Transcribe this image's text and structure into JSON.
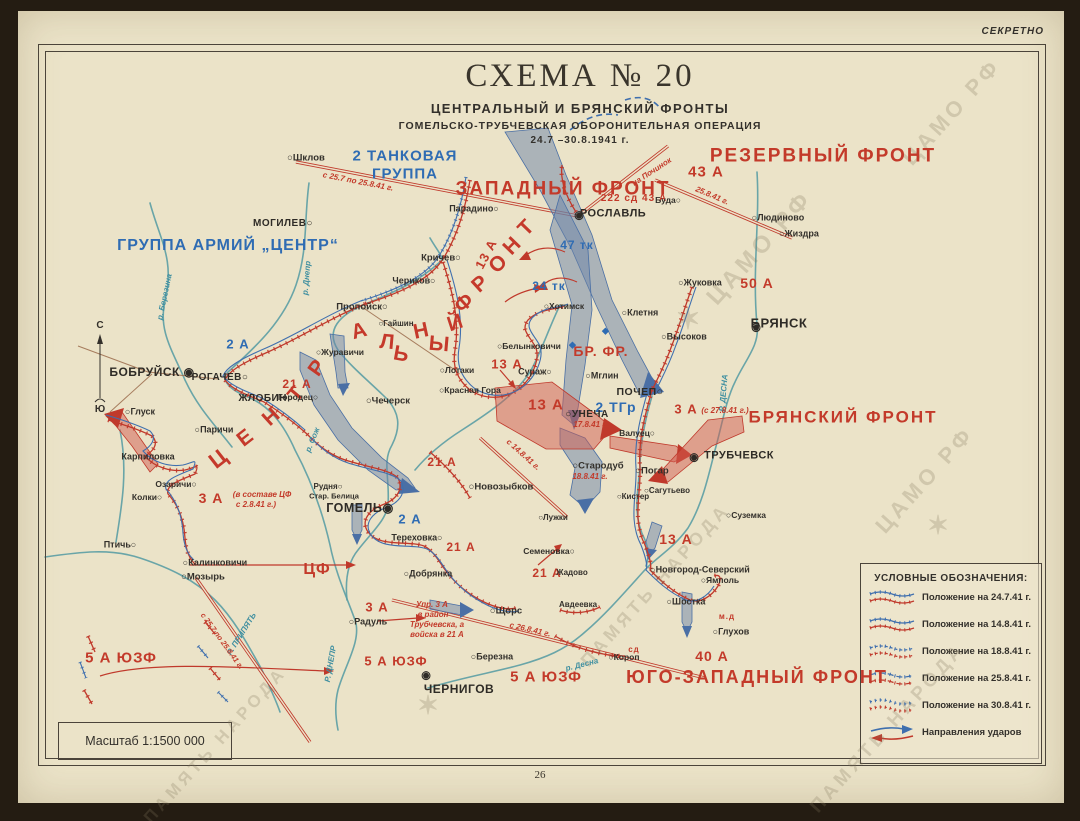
{
  "page": {
    "secret": "СЕКРЕТНО",
    "number": "26",
    "scale": "Масштаб 1:1500 000"
  },
  "title": {
    "main": "СХЕМА  № 20",
    "sub1": "ЦЕНТРАЛЬНЫЙ И БРЯНСКИЙ ФРОНТЫ",
    "sub2": "ГОМЕЛЬСКО-ТРУБЧЕВСКАЯ ОБОРОНИТЕЛЬНАЯ ОПЕРАЦИЯ",
    "dates": "24.7 –30.8.1941 г."
  },
  "colors": {
    "red": "#c0392b",
    "blue": "#2f6cb3",
    "river": "#5b9da4",
    "paper": "#ebe3c8",
    "ink": "#33302b"
  },
  "legend": {
    "title": "УСЛОВНЫЕ ОБОЗНАЧЕНИЯ:",
    "items": [
      {
        "label": "Положение на 24.7.41 г.",
        "sym": "pos1"
      },
      {
        "label": "Положение на 14.8.41 г.",
        "sym": "pos2"
      },
      {
        "label": "Положение на 18.8.41 г.",
        "sym": "pos3"
      },
      {
        "label": "Положение на 25.8.41 г.",
        "sym": "pos4"
      },
      {
        "label": "Положение на 30.8.41 г.",
        "sym": "pos5"
      },
      {
        "label": "Направления ударов",
        "sym": "arrows"
      }
    ]
  },
  "map": {
    "compass": {
      "north": "С",
      "south": "Ю"
    },
    "watermarks": [
      {
        "t": "ЦАМО РФ",
        "x": 760,
        "y": 248,
        "r": -48,
        "s": 24
      },
      {
        "t": "ЦАМО РФ",
        "x": 952,
        "y": 112,
        "r": -48,
        "s": 22
      },
      {
        "t": "ЦАМО РФ",
        "x": 925,
        "y": 480,
        "r": -48,
        "s": 22
      },
      {
        "t": "ПАМЯТЬ НАРОДА",
        "x": 888,
        "y": 728,
        "r": -48,
        "s": 19
      },
      {
        "t": "ПАМЯТЬ НАРОДА",
        "x": 215,
        "y": 745,
        "r": -48,
        "s": 17
      },
      {
        "t": "ПАМЯТЬ НАРОДА",
        "x": 655,
        "y": 585,
        "r": -48,
        "s": 18
      },
      {
        "t": "✶",
        "x": 690,
        "y": 320,
        "r": 0,
        "s": 30
      },
      {
        "t": "✶",
        "x": 940,
        "y": 525,
        "r": 0,
        "s": 26
      },
      {
        "t": "✶",
        "x": 430,
        "y": 705,
        "r": 0,
        "s": 26
      }
    ],
    "labels": [
      {
        "t": "ЗАПАДНЫЙ  ФРОНТ",
        "x": 563,
        "y": 189,
        "c": "fr",
        "s": 19
      },
      {
        "t": "РЕЗЕРВНЫЙ  ФРОНТ",
        "x": 823,
        "y": 156,
        "c": "fr",
        "s": 19
      },
      {
        "t": "БРЯНСКИЙ  ФРОНТ",
        "x": 843,
        "y": 417,
        "c": "fr",
        "s": 17
      },
      {
        "t": "ЮГО-ЗАПАДНЫЙ  ФРОНТ",
        "x": 757,
        "y": 677,
        "c": "fr",
        "s": 18
      },
      {
        "t": "2 ТАНКОВАЯ",
        "x": 405,
        "y": 156,
        "c": "ab",
        "s": 15
      },
      {
        "t": "ГРУППА",
        "x": 405,
        "y": 174,
        "c": "ab",
        "s": 15
      },
      {
        "t": "ГРУППА  АРМИЙ  „ЦЕНТР“",
        "x": 228,
        "y": 246,
        "c": "ab",
        "s": 16
      },
      {
        "t": "43 А",
        "x": 706,
        "y": 172,
        "c": "ar",
        "s": 15
      },
      {
        "t": "50 А",
        "x": 757,
        "y": 283,
        "c": "ar",
        "s": 14
      },
      {
        "t": "222 сд  43 А",
        "x": 634,
        "y": 199,
        "c": "ar",
        "s": 10
      },
      {
        "t": "13 А",
        "x": 486,
        "y": 254,
        "c": "ar",
        "s": 13,
        "r": -62
      },
      {
        "t": "13 А",
        "x": 507,
        "y": 364,
        "c": "ar",
        "s": 13
      },
      {
        "t": "13 А",
        "x": 546,
        "y": 405,
        "c": "ar",
        "s": 15
      },
      {
        "t": "13 А",
        "x": 676,
        "y": 539,
        "c": "ar",
        "s": 14
      },
      {
        "t": "21 А",
        "x": 297,
        "y": 384,
        "c": "ar",
        "s": 12
      },
      {
        "t": "21 А",
        "x": 442,
        "y": 462,
        "c": "ar",
        "s": 12
      },
      {
        "t": "21 А",
        "x": 461,
        "y": 547,
        "c": "ar",
        "s": 12
      },
      {
        "t": "21 А",
        "x": 547,
        "y": 573,
        "c": "ar",
        "s": 12
      },
      {
        "t": "3 А",
        "x": 211,
        "y": 498,
        "c": "ar",
        "s": 14
      },
      {
        "t": "3 А",
        "x": 686,
        "y": 409,
        "c": "ar",
        "s": 13
      },
      {
        "t": "3 А",
        "x": 377,
        "y": 607,
        "c": "ar",
        "s": 13
      },
      {
        "t": "5 А ЮЗФ",
        "x": 121,
        "y": 658,
        "c": "ar",
        "s": 15
      },
      {
        "t": "5 А ЮЗФ",
        "x": 396,
        "y": 661,
        "c": "ar",
        "s": 13
      },
      {
        "t": "5 А ЮЗФ",
        "x": 546,
        "y": 677,
        "c": "ar",
        "s": 15
      },
      {
        "t": "40 А",
        "x": 712,
        "y": 656,
        "c": "ar",
        "s": 14
      },
      {
        "t": "ЦФ",
        "x": 317,
        "y": 570,
        "c": "ar",
        "s": 16
      },
      {
        "t": "БР. ФР.",
        "x": 601,
        "y": 351,
        "c": "ar",
        "s": 14
      },
      {
        "t": "м.д",
        "x": 727,
        "y": 617,
        "c": "ar",
        "s": 8
      },
      {
        "t": "сд",
        "x": 634,
        "y": 650,
        "c": "ar",
        "s": 8
      },
      {
        "t": "47 тк",
        "x": 577,
        "y": 245,
        "c": "ab",
        "s": 12
      },
      {
        "t": "24 тк",
        "x": 549,
        "y": 286,
        "c": "ab",
        "s": 12
      },
      {
        "t": "2 ТГр",
        "x": 616,
        "y": 407,
        "c": "ab",
        "s": 14
      },
      {
        "t": "2 А",
        "x": 238,
        "y": 344,
        "c": "ab",
        "s": 13
      },
      {
        "t": "2 А",
        "x": 410,
        "y": 519,
        "c": "ab",
        "s": 13
      },
      {
        "t": "◆",
        "x": 573,
        "y": 345,
        "c": "ab",
        "s": 9
      },
      {
        "t": "◆",
        "x": 606,
        "y": 331,
        "c": "ab",
        "s": 9
      },
      {
        "t": "Ц",
        "x": 218,
        "y": 459,
        "c": "lt",
        "s": 22,
        "r": -38
      },
      {
        "t": "Е",
        "x": 245,
        "y": 438,
        "c": "lt",
        "s": 21,
        "r": -38
      },
      {
        "t": "Н",
        "x": 271,
        "y": 417,
        "c": "lt",
        "s": 21,
        "r": -42
      },
      {
        "t": "Т",
        "x": 296,
        "y": 394,
        "c": "lt",
        "s": 21,
        "r": -50
      },
      {
        "t": "Р",
        "x": 317,
        "y": 368,
        "c": "lt",
        "s": 21,
        "r": -55
      },
      {
        "t": "А",
        "x": 359,
        "y": 331,
        "c": "lt",
        "s": 21,
        "r": -15
      },
      {
        "t": "Л",
        "x": 387,
        "y": 342,
        "c": "lt",
        "s": 21,
        "r": 5
      },
      {
        "t": "Ь",
        "x": 401,
        "y": 354,
        "c": "lt",
        "s": 21,
        "r": 10
      },
      {
        "t": "Н",
        "x": 421,
        "y": 331,
        "c": "lt",
        "s": 21,
        "r": -12
      },
      {
        "t": "Ы",
        "x": 439,
        "y": 344,
        "c": "lt",
        "s": 21,
        "r": 5
      },
      {
        "t": "Й",
        "x": 455,
        "y": 323,
        "c": "lt",
        "s": 21,
        "r": -18
      },
      {
        "t": "Ф",
        "x": 464,
        "y": 303,
        "c": "lt",
        "s": 21,
        "r": -42
      },
      {
        "t": "Р",
        "x": 480,
        "y": 284,
        "c": "lt",
        "s": 21,
        "r": -42
      },
      {
        "t": "О",
        "x": 498,
        "y": 264,
        "c": "lt",
        "s": 21,
        "r": -44
      },
      {
        "t": "Н",
        "x": 512,
        "y": 246,
        "c": "lt",
        "s": 21,
        "r": -46
      },
      {
        "t": "Т",
        "x": 526,
        "y": 228,
        "c": "lt",
        "s": 21,
        "r": -46
      },
      {
        "t": "р. Березина",
        "x": 165,
        "y": 297,
        "c": "rv",
        "s": 8,
        "r": -78
      },
      {
        "t": "р. Днепр",
        "x": 307,
        "y": 278,
        "c": "rv",
        "s": 8,
        "r": -85
      },
      {
        "t": "р. Сож",
        "x": 313,
        "y": 440,
        "c": "rv",
        "s": 8,
        "r": -68
      },
      {
        "t": "Р. ДЕСНА",
        "x": 724,
        "y": 393,
        "c": "rv",
        "s": 8,
        "r": -85
      },
      {
        "t": "р. Десна",
        "x": 582,
        "y": 665,
        "c": "rv",
        "s": 8,
        "r": -14
      },
      {
        "t": "Р. ПРИПЯТЬ",
        "x": 242,
        "y": 634,
        "c": "rv",
        "s": 8,
        "r": -58
      },
      {
        "t": "Р. ДНЕПР",
        "x": 331,
        "y": 664,
        "c": "rv",
        "s": 8,
        "r": -80
      },
      {
        "t": "с 25.7 по 25.8.41 г.",
        "x": 358,
        "y": 182,
        "c": "nt",
        "s": 8,
        "r": 11
      },
      {
        "t": "25.8.41 г.",
        "x": 712,
        "y": 196,
        "c": "nt",
        "s": 8,
        "r": 23
      },
      {
        "t": "на Починок",
        "x": 652,
        "y": 172,
        "c": "nt",
        "s": 8,
        "r": -33
      },
      {
        "t": "с 14.8.41 г.",
        "x": 523,
        "y": 455,
        "c": "nt",
        "s": 8,
        "r": 42
      },
      {
        "t": "17.8.41 г.",
        "x": 591,
        "y": 425,
        "c": "nt",
        "s": 8
      },
      {
        "t": "18.8.41 г.",
        "x": 590,
        "y": 477,
        "c": "nt",
        "s": 8
      },
      {
        "t": "с 26.8.41 г.",
        "x": 530,
        "y": 630,
        "c": "nt",
        "s": 8,
        "r": 13
      },
      {
        "t": "(с 27.8.41 г.)",
        "x": 725,
        "y": 411,
        "c": "nt",
        "s": 8
      },
      {
        "t": "(в составе ЦФ",
        "x": 262,
        "y": 495,
        "c": "nt",
        "s": 8
      },
      {
        "t": "с 2.8.41 г.)",
        "x": 256,
        "y": 505,
        "c": "nt",
        "s": 8
      },
      {
        "t": "Упр. 3 А",
        "x": 432,
        "y": 605,
        "c": "nt",
        "s": 8
      },
      {
        "t": "в район",
        "x": 433,
        "y": 615,
        "c": "nt",
        "s": 8
      },
      {
        "t": "Трубчевска, а",
        "x": 437,
        "y": 625,
        "c": "nt",
        "s": 8
      },
      {
        "t": "войска в 21 А",
        "x": 437,
        "y": 635,
        "c": "nt",
        "s": 8
      },
      {
        "t": "с 25.7 по 25.8.41 г.",
        "x": 222,
        "y": 641,
        "c": "nt",
        "s": 7.5,
        "r": 54
      },
      {
        "t": "○Шклов",
        "x": 306,
        "y": 158,
        "c": "ct",
        "s": 9.5
      },
      {
        "t": "МОГИЛЕВ○",
        "x": 283,
        "y": 224,
        "c": "cb",
        "s": 10
      },
      {
        "t": "Парадино○",
        "x": 474,
        "y": 209,
        "c": "ct",
        "s": 9
      },
      {
        "t": "Кричев○",
        "x": 441,
        "y": 258,
        "c": "ct",
        "s": 9.5
      },
      {
        "t": "Чериков○",
        "x": 414,
        "y": 281,
        "c": "ct",
        "s": 9
      },
      {
        "t": "Пропойск○",
        "x": 362,
        "y": 307,
        "c": "ct",
        "s": 9.5
      },
      {
        "t": "○Гайшин",
        "x": 396,
        "y": 324,
        "c": "ct",
        "s": 8
      },
      {
        "t": "○Журавичи",
        "x": 340,
        "y": 352,
        "c": "ct",
        "s": 8.5
      },
      {
        "t": "БОБРУЙСК ◉",
        "x": 152,
        "y": 372,
        "c": "cb",
        "s": 12
      },
      {
        "t": "РОГАЧЕВ○",
        "x": 220,
        "y": 378,
        "c": "cb",
        "s": 10
      },
      {
        "t": "ЖЛОБИН○",
        "x": 266,
        "y": 399,
        "c": "cb",
        "s": 10
      },
      {
        "t": "Городец○",
        "x": 298,
        "y": 397,
        "c": "ct",
        "s": 8.5
      },
      {
        "t": "○Чечерск",
        "x": 388,
        "y": 401,
        "c": "ct",
        "s": 9.5
      },
      {
        "t": "○Глуск",
        "x": 140,
        "y": 412,
        "c": "ct",
        "s": 9
      },
      {
        "t": "○Паричи",
        "x": 214,
        "y": 430,
        "c": "ct",
        "s": 9
      },
      {
        "t": "Карпиловка",
        "x": 148,
        "y": 457,
        "c": "ct",
        "s": 9
      },
      {
        "t": "Озаричи○",
        "x": 176,
        "y": 484,
        "c": "ct",
        "s": 8.5
      },
      {
        "t": "Колки○",
        "x": 147,
        "y": 497,
        "c": "ct",
        "s": 8.5
      },
      {
        "t": "Рудня○",
        "x": 328,
        "y": 487,
        "c": "ct",
        "s": 8
      },
      {
        "t": "Стар. Белица",
        "x": 334,
        "y": 496,
        "c": "ct",
        "s": 7.5
      },
      {
        "t": "ГОМЕЛЬ◉",
        "x": 360,
        "y": 508,
        "c": "cb",
        "s": 12.5
      },
      {
        "t": "Птичь○",
        "x": 120,
        "y": 545,
        "c": "ct",
        "s": 9
      },
      {
        "t": "○Калинковичи",
        "x": 215,
        "y": 563,
        "c": "ct",
        "s": 9
      },
      {
        "t": "○Мозырь",
        "x": 203,
        "y": 577,
        "c": "ct",
        "s": 9.5
      },
      {
        "t": "○Новозыбков",
        "x": 501,
        "y": 487,
        "c": "ct",
        "s": 9.5
      },
      {
        "t": "Тереховка○",
        "x": 417,
        "y": 538,
        "c": "ct",
        "s": 9
      },
      {
        "t": "○Добрянка",
        "x": 428,
        "y": 574,
        "c": "ct",
        "s": 9
      },
      {
        "t": "○Радуль",
        "x": 368,
        "y": 622,
        "c": "ct",
        "s": 9
      },
      {
        "t": "○Щорс",
        "x": 506,
        "y": 611,
        "c": "ct",
        "s": 9.5
      },
      {
        "t": "○Березна",
        "x": 492,
        "y": 657,
        "c": "ct",
        "s": 9
      },
      {
        "t": "◉",
        "x": 426,
        "y": 676,
        "c": "mk",
        "s": 11
      },
      {
        "t": "ЧЕРНИГОВ",
        "x": 459,
        "y": 689,
        "c": "cb",
        "s": 12
      },
      {
        "t": "Семеновка○",
        "x": 549,
        "y": 551,
        "c": "ct",
        "s": 8.5
      },
      {
        "t": "Жадово",
        "x": 572,
        "y": 573,
        "c": "ct",
        "s": 8
      },
      {
        "t": "Авдеевка",
        "x": 578,
        "y": 605,
        "c": "ct",
        "s": 8
      },
      {
        "t": "○Короп",
        "x": 624,
        "y": 657,
        "c": "ct",
        "s": 8.5
      },
      {
        "t": "○Лужки",
        "x": 553,
        "y": 518,
        "c": "ct",
        "s": 8
      },
      {
        "t": "○Стародуб",
        "x": 598,
        "y": 466,
        "c": "ct",
        "s": 9.5
      },
      {
        "t": "○Кистер",
        "x": 633,
        "y": 497,
        "c": "ct",
        "s": 8
      },
      {
        "t": "○Сагутьево",
        "x": 667,
        "y": 491,
        "c": "ct",
        "s": 8
      },
      {
        "t": "○Погар",
        "x": 652,
        "y": 471,
        "c": "ct",
        "s": 9.5
      },
      {
        "t": "◉",
        "x": 694,
        "y": 458,
        "c": "mk",
        "s": 11
      },
      {
        "t": "ТРУБЧЕВСК",
        "x": 739,
        "y": 456,
        "c": "cb",
        "s": 11
      },
      {
        "t": "○Суземка",
        "x": 746,
        "y": 515,
        "c": "ct",
        "s": 8.5
      },
      {
        "t": "Валуец○",
        "x": 637,
        "y": 433,
        "c": "ct",
        "s": 8.5
      },
      {
        "t": "ПОЧЕП○",
        "x": 640,
        "y": 392,
        "c": "cb",
        "s": 10.5
      },
      {
        "t": "○Мглин",
        "x": 602,
        "y": 376,
        "c": "ct",
        "s": 9
      },
      {
        "t": "○УНЕЧА",
        "x": 587,
        "y": 415,
        "c": "cb",
        "s": 10
      },
      {
        "t": "Сураж○",
        "x": 535,
        "y": 372,
        "c": "ct",
        "s": 9
      },
      {
        "t": "○Белынковичи",
        "x": 529,
        "y": 346,
        "c": "ct",
        "s": 8.5
      },
      {
        "t": "○Лотаки",
        "x": 457,
        "y": 370,
        "c": "ct",
        "s": 8.5
      },
      {
        "t": "○Красная Гора",
        "x": 470,
        "y": 390,
        "c": "ct",
        "s": 8.5
      },
      {
        "t": "○Хотимск",
        "x": 564,
        "y": 306,
        "c": "ct",
        "s": 8.5
      },
      {
        "t": "○Клетня",
        "x": 640,
        "y": 313,
        "c": "ct",
        "s": 9
      },
      {
        "t": "○Высоков",
        "x": 684,
        "y": 337,
        "c": "ct",
        "s": 9
      },
      {
        "t": "○Жуковка",
        "x": 700,
        "y": 283,
        "c": "ct",
        "s": 9
      },
      {
        "t": "◉",
        "x": 756,
        "y": 328,
        "c": "mk",
        "s": 11
      },
      {
        "t": "БРЯНСК",
        "x": 779,
        "y": 323,
        "c": "cb",
        "s": 13
      },
      {
        "t": "○Людиново",
        "x": 778,
        "y": 218,
        "c": "ct",
        "s": 9
      },
      {
        "t": "○Жиздра",
        "x": 799,
        "y": 234,
        "c": "ct",
        "s": 9
      },
      {
        "t": "Буда○",
        "x": 668,
        "y": 200,
        "c": "ct",
        "s": 8.5
      },
      {
        "t": "◉",
        "x": 579,
        "y": 216,
        "c": "mk",
        "s": 11
      },
      {
        "t": "РОСЛАВЛЬ",
        "x": 613,
        "y": 214,
        "c": "cb",
        "s": 11
      },
      {
        "t": "○Новгород-Северский",
        "x": 700,
        "y": 570,
        "c": "ct",
        "s": 9
      },
      {
        "t": "○Ямполь",
        "x": 720,
        "y": 580,
        "c": "ct",
        "s": 8.5
      },
      {
        "t": "○Шостка",
        "x": 686,
        "y": 602,
        "c": "ct",
        "s": 9
      },
      {
        "t": "○Глухов",
        "x": 731,
        "y": 632,
        "c": "ct",
        "s": 9
      }
    ]
  }
}
